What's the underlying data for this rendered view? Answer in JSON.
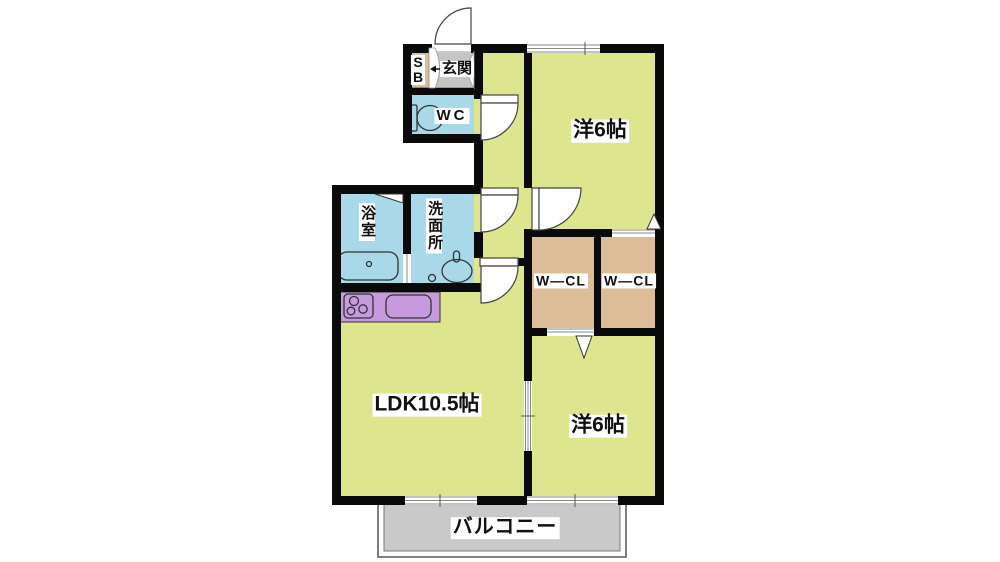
{
  "floorplan": {
    "title": "2LDK apartment floor plan",
    "labels": {
      "shoe_box_line1": "S",
      "shoe_box_line2": "B",
      "entrance": "玄関",
      "toilet": "WC",
      "bathroom": "浴室",
      "washroom": "洗面所",
      "closet_left": "W―CL",
      "closet_right": "W―CL",
      "bedroom_top": "洋6帖",
      "bedroom_bottom": "洋6帖",
      "ldk": "LDK10.5帖",
      "balcony": "バルコニー"
    },
    "colors": {
      "wall": "#0a0a0a",
      "room_yellow": "#dde58f",
      "wet_area_blue": "#a9d8e8",
      "closet_tan": "#dcbd98",
      "kitchen_purple": "#c79ade",
      "entrance_gray": "#c5c5c7",
      "balcony_gray": "#c9c9c9",
      "door_white": "#ffffff"
    }
  }
}
